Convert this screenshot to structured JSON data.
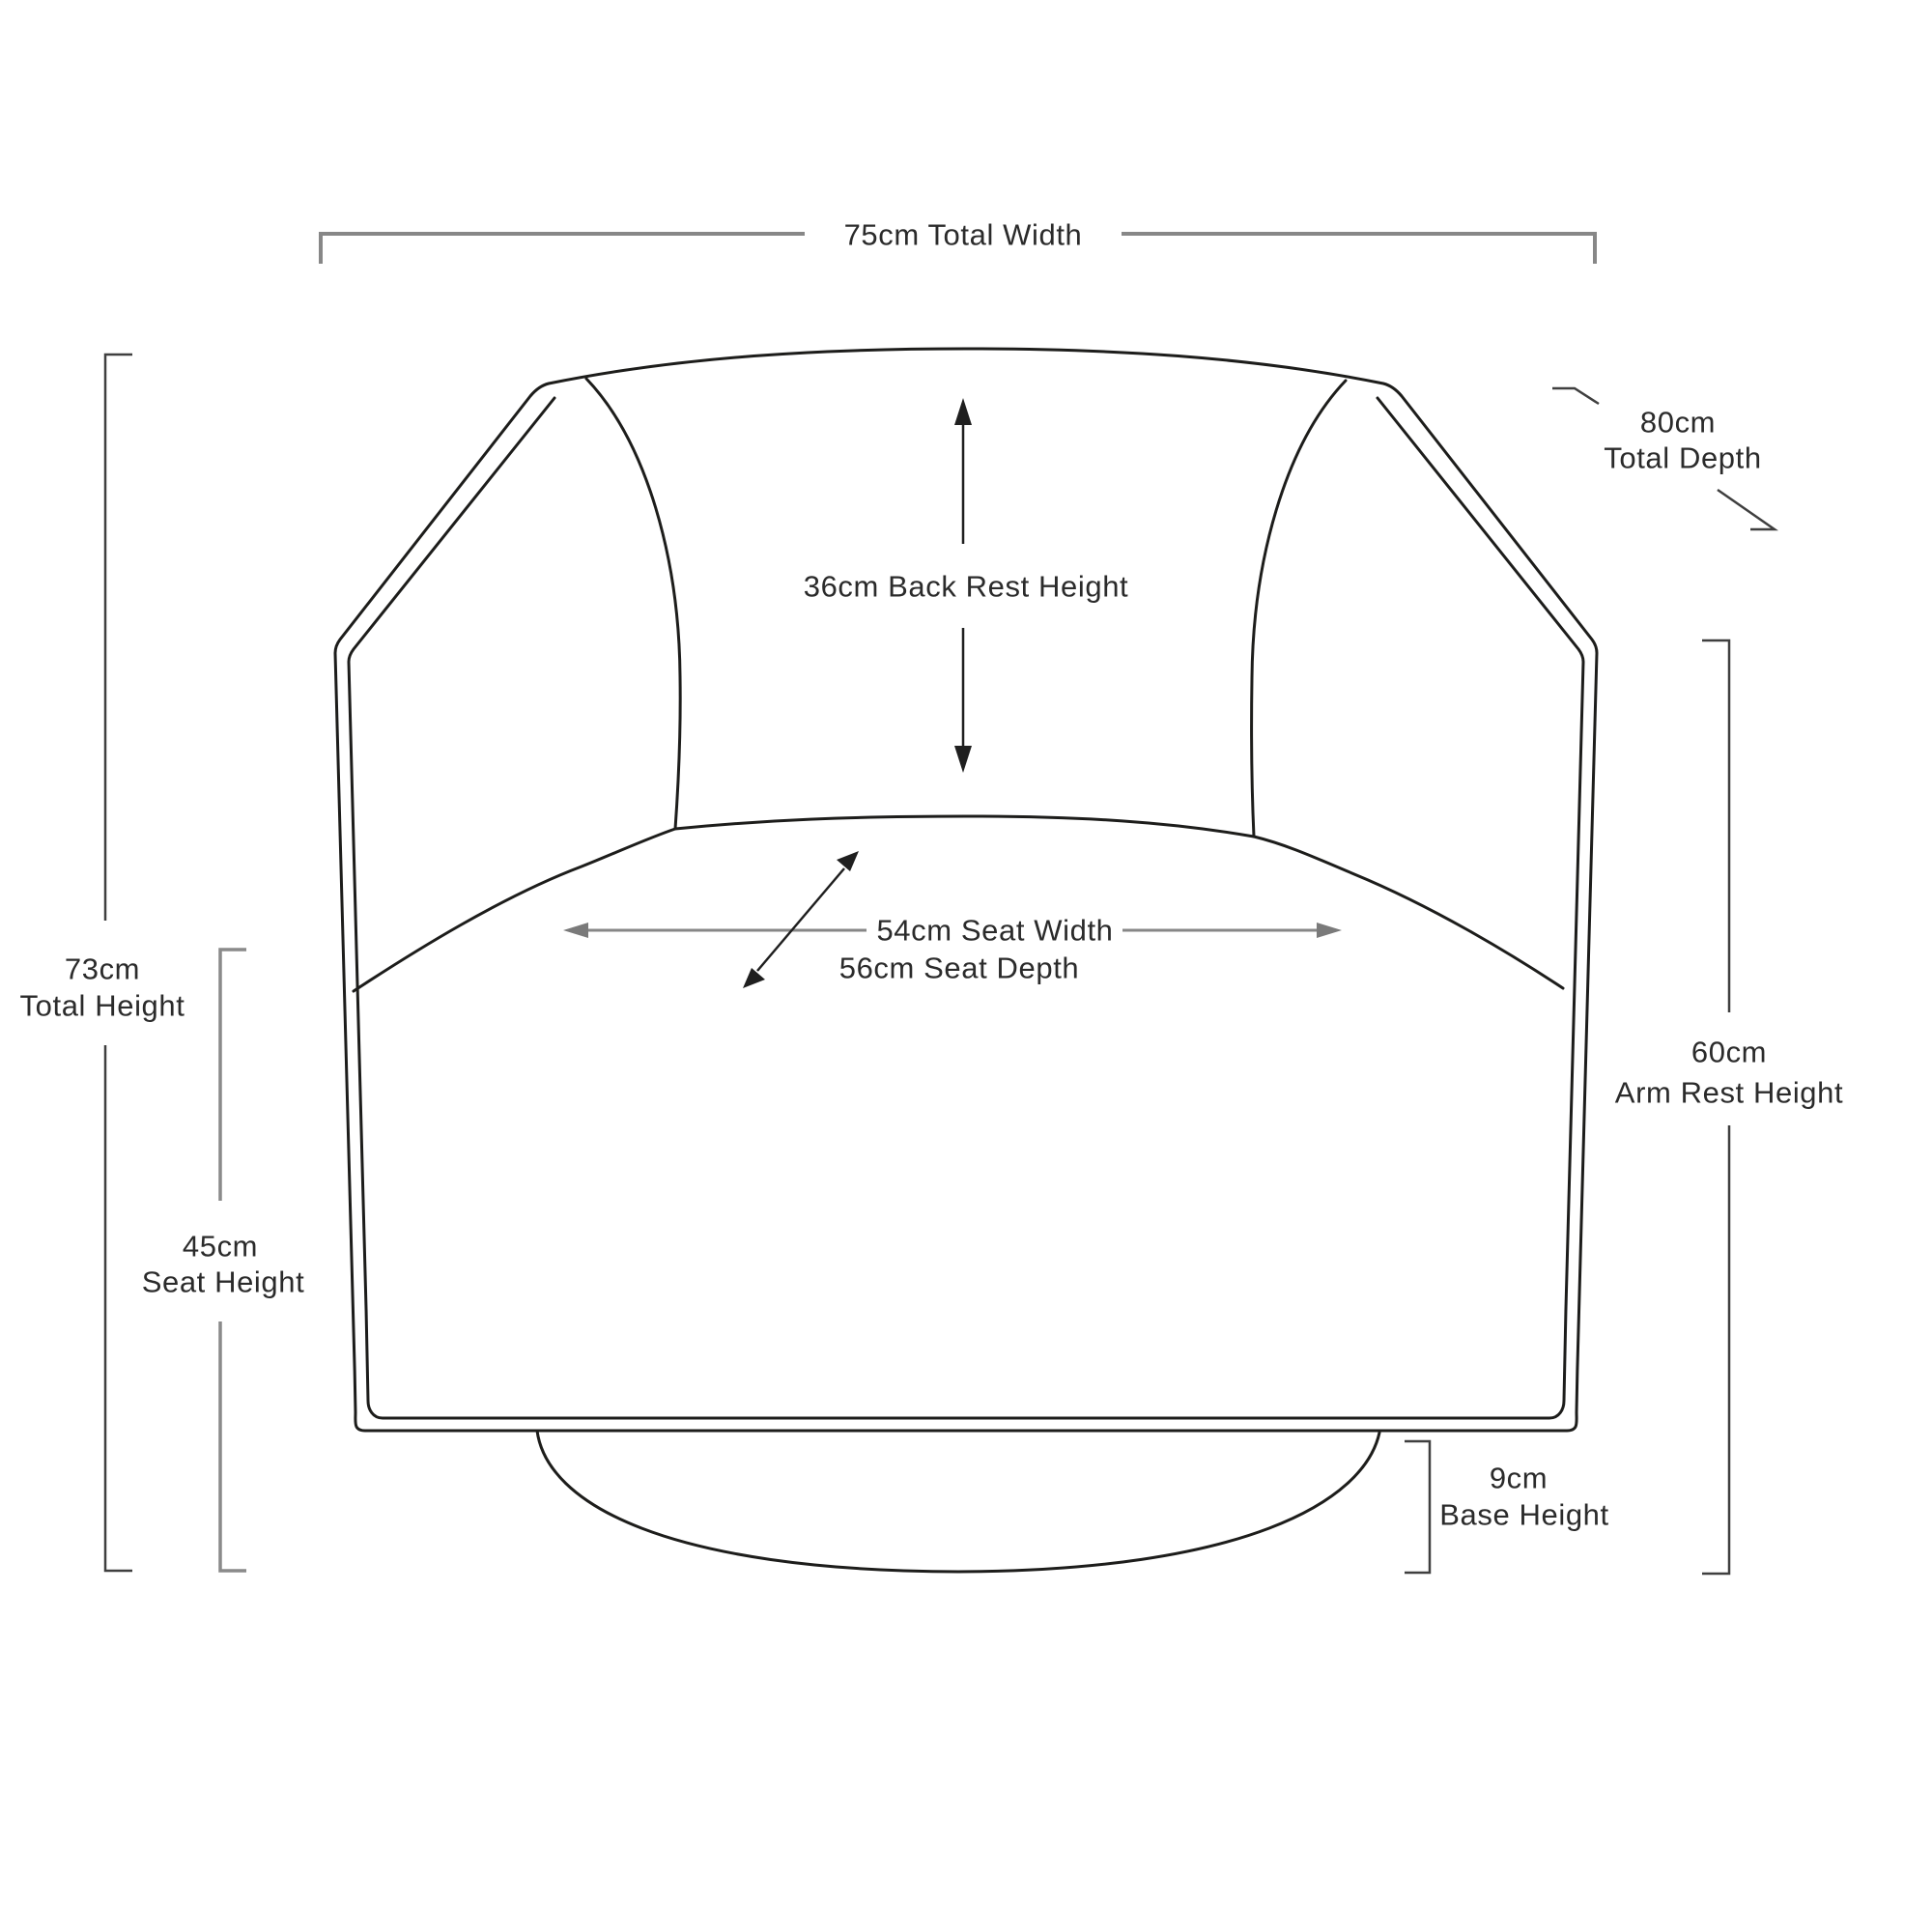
{
  "diagram": {
    "type": "furniture-dimension-diagram",
    "subject": "swivel tub armchair, front elevation line drawing with dimension annotations",
    "background_color": "#ffffff",
    "drawing_line_color": "#1d1d1b",
    "dimension_line_color": "#878787",
    "dimension_dark_line_color": "#3f3f3f",
    "text_color": "#2b2b2b",
    "measurements": {
      "total_width": {
        "value": "75cm",
        "label": "Total Width",
        "text": "75cm Total Width"
      },
      "total_depth": {
        "value": "80cm",
        "label": "Total Depth"
      },
      "back_rest_height": {
        "value": "36cm",
        "label": "Back Rest Height",
        "text": "36cm Back Rest Height"
      },
      "seat_width": {
        "value": "54cm",
        "label": "Seat Width",
        "text": "54cm Seat Width"
      },
      "seat_depth": {
        "value": "56cm",
        "label": "Seat Depth",
        "text": "56cm Seat Depth"
      },
      "total_height": {
        "value": "73cm",
        "label": "Total Height"
      },
      "seat_height": {
        "value": "45cm",
        "label": "Seat Height"
      },
      "arm_rest_height": {
        "value": "60cm",
        "label": "Arm Rest Height"
      },
      "base_height": {
        "value": "9cm",
        "label": "Base Height"
      }
    }
  }
}
